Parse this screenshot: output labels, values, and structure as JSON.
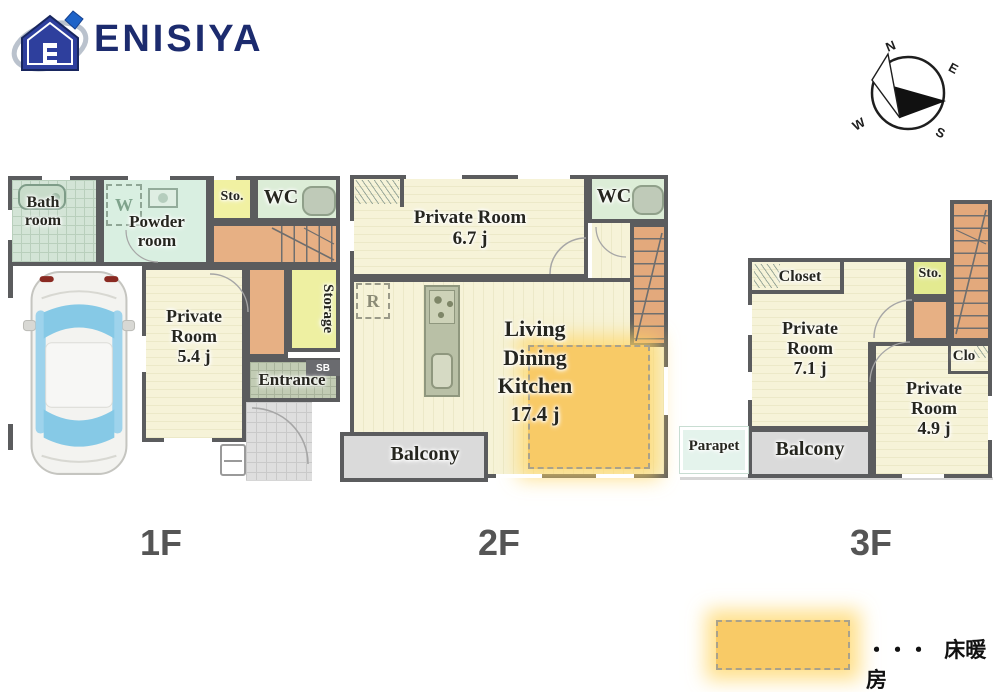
{
  "brand": {
    "name": "ENISIYA",
    "color": "#1c2b6e"
  },
  "compass": {
    "n": "N",
    "e": "E",
    "s": "S",
    "w": "W"
  },
  "floor1": {
    "label": "1F",
    "bath": "Bath room",
    "powder": "Powder room",
    "washer": "W",
    "sto": "Sto.",
    "wc": "WC",
    "storage": "Storage",
    "private": "Private Room",
    "private_size": "5.4 j",
    "entrance": "Entrance",
    "sb": "SB"
  },
  "floor2": {
    "label": "2F",
    "private": "Private Room",
    "private_size": "6.7 j",
    "wc": "WC",
    "fridge": "R",
    "ldk_lines": [
      "Living",
      "Dining",
      "Kitchen"
    ],
    "ldk_size": "17.4 j",
    "balcony": "Balcony"
  },
  "floor3": {
    "label": "3F",
    "closet": "Closet",
    "sto": "Sto.",
    "private1": "Private Room",
    "private1_size": "7.1 j",
    "clo": "Clo",
    "private2": "Private Room",
    "private2_size": "4.9 j",
    "parapet": "Parapet",
    "balcony": "Balcony"
  },
  "legend": {
    "dots": "・・・",
    "label": "床暖房"
  },
  "colors": {
    "wall": "#5b5c5e",
    "room_cream": "#f6f3d8",
    "mint": "#d9efe1",
    "bath_green": "#d3e4d6",
    "wc_green": "#dcedd7",
    "storage_yellow": "#eef0a2",
    "hall_orange": "#e7b084",
    "balcony_gray": "#dadada",
    "entrance_tile": "#c2ccb4",
    "parapet_mint": "#e4f3ec",
    "floor_heating": "#f8ca66",
    "logo_navy": "#1c2b6e"
  }
}
